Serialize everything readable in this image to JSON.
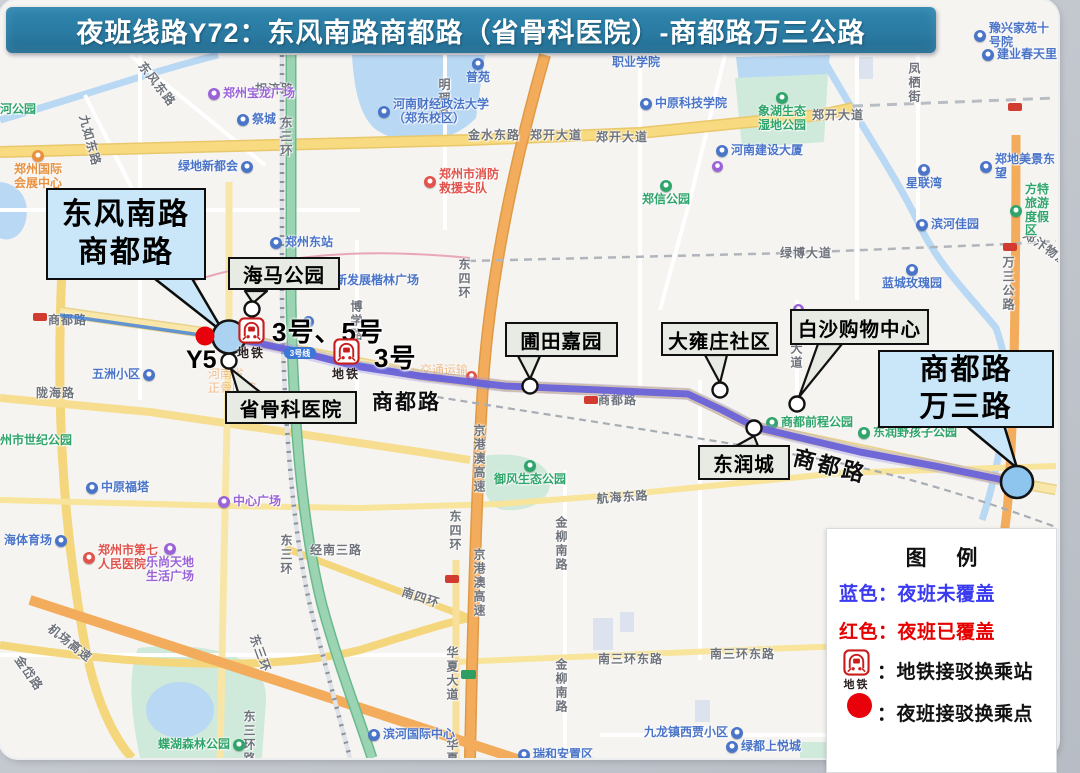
{
  "banner": {
    "title": "夜班线路Y72：东风南路商都路（省骨科医院）-商都路万三公路"
  },
  "route": {
    "name": "商都路",
    "color": "#6a62d8",
    "points": "229,337 300,352 355,366 420,376 505,386 600,390 688,394 722,410 755,427 860,452 935,466 1018,483"
  },
  "metro_feeder_line": {
    "badge": "3号线",
    "points": "60,315 229,339 360,364 490,387"
  },
  "callouts": {
    "start": {
      "line1": "东风南路",
      "line2": "商都路"
    },
    "end": {
      "line1": "商都路",
      "line2": "万三路"
    },
    "stops": [
      {
        "label": "海马公园",
        "box": [
          228,
          257,
          112,
          33
        ],
        "circle": [
          252,
          309
        ],
        "tri": "245,291 267,291 253,303"
      },
      {
        "label": "省骨科医院",
        "box": [
          225,
          391,
          132,
          33
        ],
        "circle": [
          229,
          361
        ],
        "tri": "238,392 260,392 231,369"
      },
      {
        "label": "圃田嘉园",
        "box": [
          505,
          322,
          113,
          35
        ],
        "circle": [
          530,
          386
        ],
        "tri": "518,356 540,356 530,379"
      },
      {
        "label": "大雍庄社区",
        "box": [
          661,
          322,
          117,
          34
        ],
        "circle": [
          720,
          390
        ],
        "tri": "705,355 727,355 720,383"
      },
      {
        "label": "白沙购物中心",
        "box": [
          790,
          309,
          139,
          36
        ],
        "circle": [
          797,
          404
        ],
        "tri": "818,344 842,344 799,397"
      },
      {
        "label": "东润城",
        "box": [
          698,
          445,
          92,
          35
        ],
        "circle": [
          754,
          428
        ],
        "tri": "736,446 758,446 754,436"
      }
    ]
  },
  "markers": {
    "start_circle": [
      229,
      337
    ],
    "end_circle": [
      1017,
      482
    ],
    "red_dot": [
      205,
      336
    ],
    "red_dot_label": "Y5",
    "metro_caption": "地铁",
    "metro_stations": [
      {
        "x": 250,
        "y": 330,
        "label": "3号、5号",
        "lx": 272,
        "ly": 312
      },
      {
        "x": 345,
        "y": 351,
        "label": "3号",
        "lx": 374,
        "ly": 338
      }
    ]
  },
  "legend": {
    "title": "图 例",
    "blue_item": {
      "label": "蓝色：夜班未覆盖",
      "color": "#3a3af0"
    },
    "red_item": {
      "label": "红色：夜班已覆盖",
      "color": "#e60000"
    },
    "metro_item": {
      "label": "：地铁接驳换乘站"
    },
    "dot_item": {
      "label": "：夜班接驳换乘点"
    }
  },
  "map": {
    "road_labels": [
      {
        "t": "东风东路",
        "x": 148,
        "y": 58,
        "rot": 52
      },
      {
        "t": "九如东路",
        "x": 92,
        "y": 113,
        "rot": 75
      },
      {
        "t": "相济路",
        "x": 255,
        "y": 80
      },
      {
        "t": "东三环",
        "x": 278,
        "y": 116,
        "vert": true
      },
      {
        "t": "明理路",
        "x": 436,
        "y": 78,
        "vert": true
      },
      {
        "t": "金水东路",
        "x": 468,
        "y": 126
      },
      {
        "t": "郑开大道",
        "x": 530,
        "y": 126
      },
      {
        "t": "郑开大道",
        "x": 596,
        "y": 128
      },
      {
        "t": "郑开大道",
        "x": 812,
        "y": 106
      },
      {
        "t": "凤栖街",
        "x": 906,
        "y": 62,
        "vert": true
      },
      {
        "t": "博学路",
        "x": 348,
        "y": 300,
        "vert": true
      },
      {
        "t": "绿博大道",
        "x": 780,
        "y": 244
      },
      {
        "t": "万三公路",
        "x": 1000,
        "y": 256,
        "vert": true
      },
      {
        "t": "大道",
        "x": 788,
        "y": 342,
        "vert": true
      },
      {
        "t": "东四环",
        "x": 456,
        "y": 258,
        "vert": true
      },
      {
        "t": "东四环",
        "x": 447,
        "y": 510,
        "vert": true
      },
      {
        "t": "京港澳高速",
        "x": 471,
        "y": 424,
        "vert": true
      },
      {
        "t": "京港澳高速",
        "x": 471,
        "y": 548,
        "vert": true
      },
      {
        "t": "商都路",
        "x": 48,
        "y": 311
      },
      {
        "t": "商都路",
        "x": 372,
        "y": 386,
        "cls": "big"
      },
      {
        "t": "商都路",
        "x": 598,
        "y": 391
      },
      {
        "t": "商都路",
        "x": 798,
        "y": 440,
        "rot": 14,
        "cls": "big2"
      },
      {
        "t": "航海东路",
        "x": 596,
        "y": 490,
        "rot": -4
      },
      {
        "t": "经南三路",
        "x": 310,
        "y": 541
      },
      {
        "t": "南三环东路",
        "x": 598,
        "y": 650
      },
      {
        "t": "南三环东路",
        "x": 710,
        "y": 645
      },
      {
        "t": "金柳南路",
        "x": 553,
        "y": 516,
        "vert": true
      },
      {
        "t": "金柳南路",
        "x": 553,
        "y": 658,
        "vert": true
      },
      {
        "t": "华夏大道",
        "x": 444,
        "y": 646,
        "vert": true
      },
      {
        "t": "华夏大",
        "x": 444,
        "y": 738,
        "vert": true
      },
      {
        "t": "机场高速",
        "x": 55,
        "y": 620,
        "rot": 38
      },
      {
        "t": "南四环",
        "x": 405,
        "y": 583,
        "rot": 18
      },
      {
        "t": "东三环",
        "x": 278,
        "y": 534,
        "vert": true
      },
      {
        "t": "东三环",
        "x": 262,
        "y": 632,
        "rot": 70
      },
      {
        "t": "东三环路",
        "x": 241,
        "y": 710,
        "vert": true
      },
      {
        "t": "陇海路",
        "x": 36,
        "y": 384
      },
      {
        "t": "金岱路",
        "x": 25,
        "y": 652,
        "rot": 55
      },
      {
        "t": "郑汴物流",
        "x": 1030,
        "y": 226,
        "rot": 35
      }
    ],
    "poi_labels": [
      {
        "t": "郑州宝龙广场",
        "x": 208,
        "y": 87,
        "c": "purple",
        "pin": "l"
      },
      {
        "t": "祭城",
        "x": 237,
        "y": 113,
        "c": "blue",
        "pin": "l"
      },
      {
        "t": "绿地新都会",
        "x": 178,
        "y": 160,
        "c": "blue",
        "pin": "r"
      },
      {
        "t": "郑州国际\n会展中心",
        "x": 14,
        "y": 150,
        "c": "orange",
        "pin": "t"
      },
      {
        "t": "河公园",
        "x": 0,
        "y": 103,
        "c": "green",
        "pin": "n"
      },
      {
        "t": "普苑",
        "x": 466,
        "y": 58,
        "c": "blue",
        "pin": "t"
      },
      {
        "t": "河南财经政法大学\n（郑东校区）",
        "x": 378,
        "y": 98,
        "c": "blue",
        "pin": "l"
      },
      {
        "t": "职业学院",
        "x": 612,
        "y": 56,
        "c": "blue",
        "pin": "n"
      },
      {
        "t": "中原科技学院",
        "x": 640,
        "y": 97,
        "c": "blue",
        "pin": "l"
      },
      {
        "t": "河南建设大厦",
        "x": 716,
        "y": 144,
        "c": "blue",
        "pin": "l"
      },
      {
        "t": "郑州市消防\n救援支队",
        "x": 424,
        "y": 168,
        "c": "red",
        "pin": "l"
      },
      {
        "t": "郑信公园",
        "x": 642,
        "y": 180,
        "c": "green",
        "pin": "t"
      },
      {
        "t": "豫兴家苑十号院",
        "x": 974,
        "y": 22,
        "c": "blue",
        "pin": "l"
      },
      {
        "t": "建业春天里",
        "x": 982,
        "y": 48,
        "c": "blue",
        "pin": "l"
      },
      {
        "t": "象湖生态\n湿地公园",
        "x": 758,
        "y": 92,
        "c": "green",
        "pin": "t"
      },
      {
        "t": "星联湾",
        "x": 906,
        "y": 164,
        "c": "blue",
        "pin": "t"
      },
      {
        "t": "方特旅游度假区",
        "x": 1010,
        "y": 183,
        "c": "green",
        "pin": "l"
      },
      {
        "t": "滨河佳园",
        "x": 916,
        "y": 218,
        "c": "blue",
        "pin": "l"
      },
      {
        "t": "蓝城玫瑰园",
        "x": 882,
        "y": 264,
        "c": "blue",
        "pin": "t"
      },
      {
        "t": "郑地美景东望",
        "x": 980,
        "y": 153,
        "c": "blue",
        "pin": "l"
      },
      {
        "t": "郑州东站",
        "x": 270,
        "y": 236,
        "c": "blue",
        "pin": "l"
      },
      {
        "t": "新发展楷林广场",
        "x": 335,
        "y": 274,
        "c": "blue",
        "pin": "n"
      },
      {
        "t": "五洲小区",
        "x": 92,
        "y": 368,
        "c": "blue",
        "pin": "r"
      },
      {
        "t": "中原福塔",
        "x": 86,
        "y": 481,
        "c": "blue",
        "pin": "l"
      },
      {
        "t": "海体育场",
        "x": 4,
        "y": 534,
        "c": "blue",
        "pin": "r"
      },
      {
        "t": "郑州市第七\n人民医院",
        "x": 83,
        "y": 544,
        "c": "red",
        "pin": "l"
      },
      {
        "t": "乐尚天地\n生活广场",
        "x": 146,
        "y": 543,
        "c": "purple",
        "pin": "t"
      },
      {
        "t": "中心广场",
        "x": 218,
        "y": 495,
        "c": "purple",
        "pin": "l"
      },
      {
        "t": "州市世纪公园",
        "x": 0,
        "y": 434,
        "c": "green",
        "pin": "n"
      },
      {
        "t": "御风生态公园",
        "x": 494,
        "y": 460,
        "c": "green",
        "pin": "t"
      },
      {
        "t": "商都前程公园",
        "x": 766,
        "y": 416,
        "c": "green",
        "pin": "l"
      },
      {
        "t": "东润野孩子公园",
        "x": 858,
        "y": 426,
        "c": "green",
        "pin": "l"
      },
      {
        "t": "滨河国际中心",
        "x": 368,
        "y": 728,
        "c": "blue",
        "pin": "l"
      },
      {
        "t": "九龙镇西贾小区",
        "x": 644,
        "y": 726,
        "c": "blue",
        "pin": "r"
      },
      {
        "t": "绿都上悦城",
        "x": 726,
        "y": 740,
        "c": "blue",
        "pin": "l"
      },
      {
        "t": "瑞和安置区",
        "x": 518,
        "y": 748,
        "c": "blue",
        "pin": "l"
      },
      {
        "t": "蝶湖森林公园",
        "x": 158,
        "y": 738,
        "c": "green",
        "pin": "r"
      },
      {
        "t": "河南省\n正骨医院",
        "x": 208,
        "y": 368,
        "c": "orange",
        "pin": "n",
        "dim": true
      },
      {
        "t": "交通运输",
        "x": 420,
        "y": 364,
        "c": "orange",
        "pin": "n",
        "dim": true
      }
    ],
    "shields": [
      {
        "x": 584,
        "y": 396,
        "c": "red"
      },
      {
        "x": 33,
        "y": 313,
        "c": "red"
      },
      {
        "x": 1003,
        "y": 243,
        "c": "red"
      },
      {
        "x": 1008,
        "y": 103,
        "c": "red"
      },
      {
        "x": 445,
        "y": 575,
        "c": "red"
      },
      {
        "x": 461,
        "y": 670,
        "c": "green"
      }
    ],
    "dots": [
      {
        "x": 712,
        "y": 161,
        "c": "purple"
      },
      {
        "x": 793,
        "y": 304,
        "c": "purple"
      },
      {
        "x": 466,
        "y": 371,
        "c": "red"
      },
      {
        "x": 303,
        "y": 316,
        "c": "blue"
      }
    ]
  }
}
